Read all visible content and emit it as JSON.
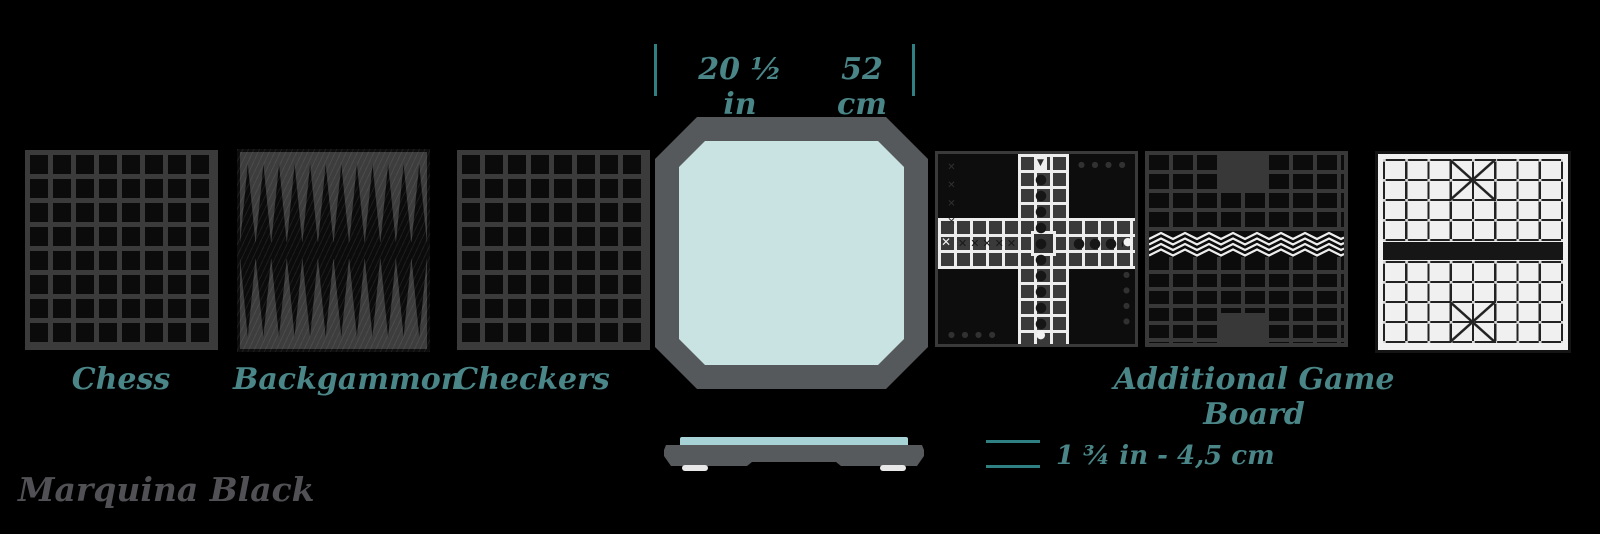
{
  "header_dimensions": {
    "width_imperial": "20 ½ in",
    "width_metric": "52 cm"
  },
  "boards": {
    "chess_label": "Chess",
    "backgammon_label": "Backgammon",
    "checkers_label": "Checkers",
    "additional_label": "Additional Game Board"
  },
  "side_view": {
    "thickness_label": "1 ¾ in - 4,5 cm"
  },
  "material_label": "Marquina Black",
  "pachisi": {
    "start_triangle": "▼",
    "entry_cross": "✕",
    "end_circle": "●",
    "home_circle": "●",
    "left_arm_marks": "✕✕✕✕✕",
    "corner_marks_x": "✕ ✕ ✕ ✕",
    "corner_marks_dots": "● ● ● ●"
  },
  "colors": {
    "background": "#000000",
    "teal_text": "#4a8688",
    "dimension_line": "#2e8083",
    "board_grid_gray": "#3a3a3a",
    "board_black": "#0b0b0b",
    "octagon_border": "#56595c",
    "octagon_surface": "#c9e2e2",
    "side_top_surface": "#a7d3d7",
    "material_text": "#515155",
    "board_line_white": "#ededed"
  }
}
